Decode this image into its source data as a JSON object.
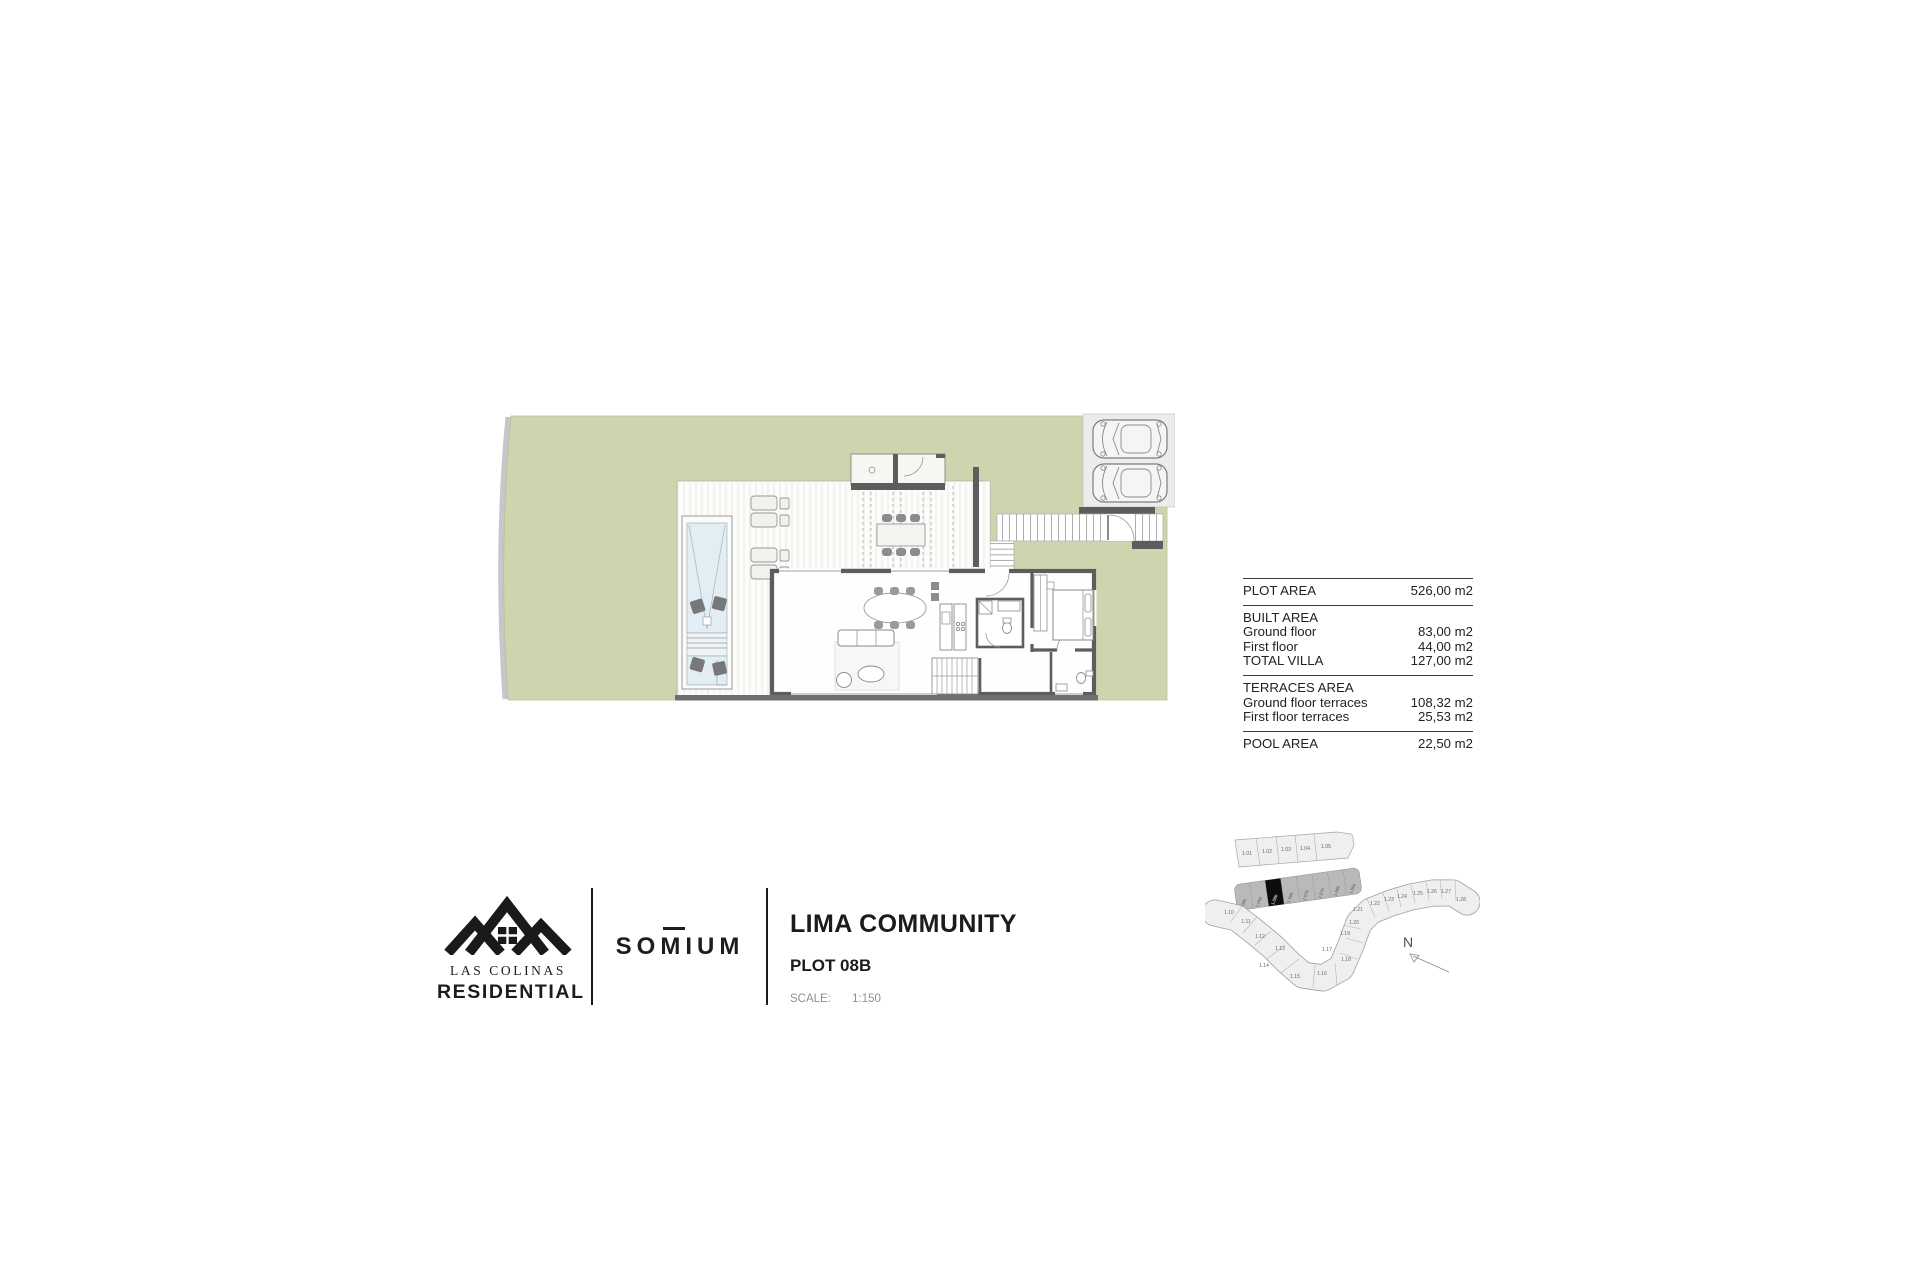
{
  "document": {
    "type": "floor plan sheet",
    "background": "#ffffff"
  },
  "areas_table": {
    "sections": [
      {
        "rows": [
          {
            "label": "PLOT AREA",
            "value": "526,00 m2"
          }
        ]
      },
      {
        "rows": [
          {
            "label": "BUILT AREA",
            "value": ""
          },
          {
            "label": "Ground floor",
            "value": "83,00 m2"
          },
          {
            "label": "First floor",
            "value": "44,00 m2"
          },
          {
            "label": "TOTAL VILLA",
            "value": "127,00 m2"
          }
        ]
      },
      {
        "rows": [
          {
            "label": "TERRACES AREA",
            "value": ""
          },
          {
            "label": "Ground floor terraces",
            "value": "108,32 m2"
          },
          {
            "label": "First floor terraces",
            "value": "25,53 m2"
          }
        ]
      },
      {
        "rows": [
          {
            "label": "POOL AREA",
            "value": "22,50 m2"
          }
        ]
      }
    ]
  },
  "branding": {
    "las_colinas_line1": "LAS COLINAS",
    "las_colinas_line2": "RESIDENTIAL",
    "somium": "SOMIUM"
  },
  "title_block": {
    "title": "LIMA COMMUNITY",
    "plot": "PLOT 08B",
    "scale_label": "SCALE:",
    "scale_value": "1:150"
  },
  "floor_plan": {
    "colors": {
      "grass": "#cfd4ae",
      "wall": "#5d5d5d",
      "parking_bg": "#ececea",
      "pool_water": "#e3edf4",
      "deck": "#fcfcfa",
      "sidewalk": "#c7c7cb"
    }
  },
  "site_map": {
    "top_row": [
      "1.01",
      "1.02",
      "1.03",
      "1.04",
      "1.05"
    ],
    "strip_row": [
      "1.09b",
      "1.09a",
      "1.08b",
      "1.08a",
      "1.07b",
      "1.07a",
      "1.06b",
      "1.06a"
    ],
    "highlighted_plot": "1.08b",
    "ribbon_plots": [
      "1.10",
      "1.11",
      "1.12",
      "1.13",
      "1.14",
      "1.15",
      "1.16",
      "1.17",
      "1.18",
      "1.19",
      "1.20",
      "1.21",
      "1.22",
      "1.23",
      "1.24",
      "1.25",
      "1.26",
      "1.27",
      "1.28"
    ],
    "north_label": "N"
  }
}
